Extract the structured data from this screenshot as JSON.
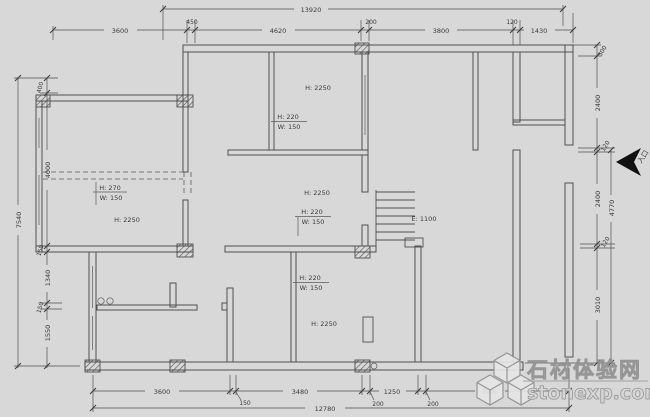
{
  "drawing": {
    "dimensions_top": {
      "total": "13920",
      "segments": [
        "3600",
        "450",
        "4620",
        "200",
        "3800",
        "120",
        "1430"
      ]
    },
    "dimensions_bottom": {
      "total": "12780",
      "segments": [
        "3600",
        "150",
        "3480",
        "200",
        "1250",
        "200",
        "3900"
      ]
    },
    "dimensions_left": {
      "total": "7540",
      "segments": [
        "400",
        "4000",
        "150",
        "1340",
        "150",
        "1550"
      ]
    },
    "dimensions_right": {
      "outer_total": "4770",
      "segments": [
        "300",
        "2400",
        "120",
        "2400",
        "120",
        "3010"
      ]
    },
    "room_labels": {
      "upper": "H: 2250",
      "left": "H: 2250",
      "middle": "H: 2250",
      "lower": "H: 2250"
    },
    "opening_labels": {
      "left": {
        "top": "H: 270",
        "bottom": "W: 150"
      },
      "upper": {
        "top": "H: 220",
        "bottom": "W: 150"
      },
      "middle": {
        "top": "H: 220",
        "bottom": "W: 150"
      },
      "lower": {
        "top": "H: 220",
        "bottom": "W: 150"
      }
    },
    "stair_label": "E: 1100",
    "entrance_label": "入口"
  },
  "watermark": {
    "line1": "石材体验网",
    "line2": "stonexp.com"
  },
  "colors": {
    "background": "#d8d8d8",
    "line": "#4f4f4f",
    "text": "#3a3a3a",
    "watermark_fill": "#d6d6d6",
    "watermark_stroke": "#8f8f8f",
    "arrow": "#111111"
  }
}
